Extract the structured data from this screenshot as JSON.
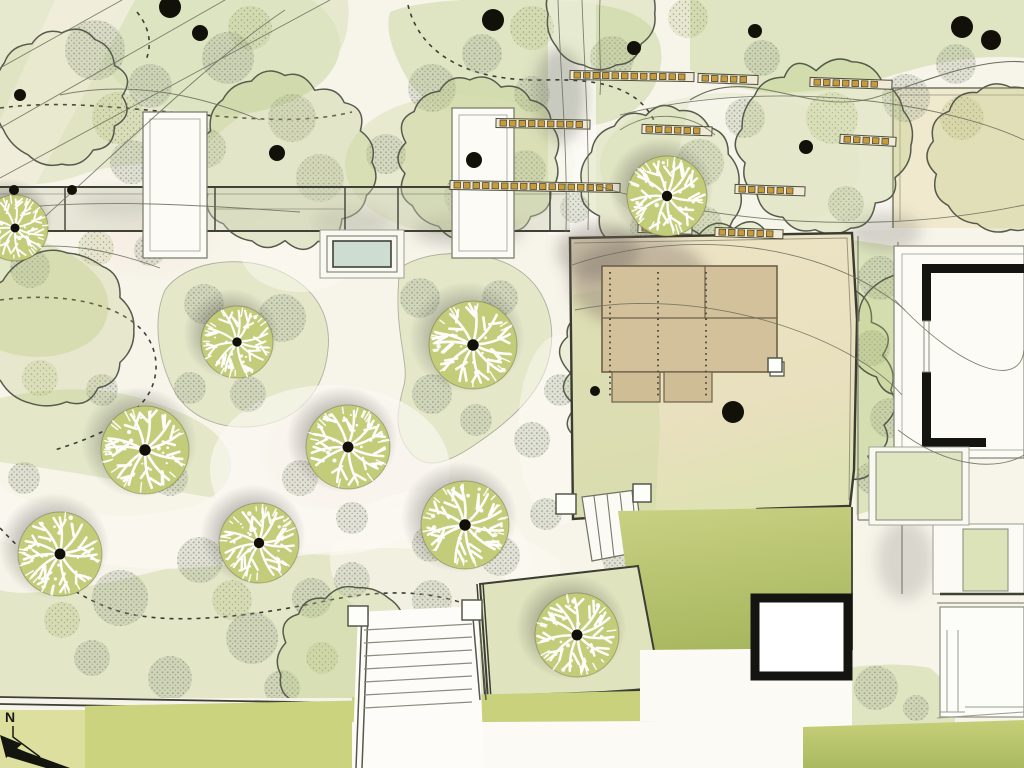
{
  "meta": {
    "type": "landscape-site-plan"
  },
  "north": {
    "label": "N"
  },
  "palette": {
    "paper": "#f7f4ea",
    "path_white": "#fbf9f2",
    "bed_green": "#e3e7c8",
    "bed_green_dark": "#dce3bd",
    "bright_bed": "#ccd37f",
    "lawn_top": "#c9d183",
    "lawn_bottom": "#a5b55c",
    "cream_lawn": "#f0e9cd",
    "terrace_cream": "#ebe3c3",
    "deck_tan": "#d3c19c",
    "deck_line": "#6e6049",
    "fence_amber": "#c89b3a",
    "fence_base": "#efe9d6",
    "tree_fill": "#c3cc79",
    "canopy_fill": "#b9c77e",
    "stipple_gray": "#8f9784",
    "stipple_olive": "#93a162",
    "ink": "#3c3e34",
    "ink_soft": "#565b4d",
    "wall_gray": "#7d8071",
    "water": "#cdddd2",
    "dot_black": "#111109",
    "shrub_wash_gray": "rgba(150,158,136,0.24)",
    "shrub_wash_olive": "rgba(165,175,115,0.20)"
  },
  "plan": {
    "round_trees": [
      {
        "x": 15,
        "y": 228,
        "r": 33
      },
      {
        "x": 237,
        "y": 342,
        "r": 36
      },
      {
        "x": 473,
        "y": 345,
        "r": 44
      },
      {
        "x": 667,
        "y": 196,
        "r": 40
      },
      {
        "x": 145,
        "y": 450,
        "r": 44
      },
      {
        "x": 348,
        "y": 447,
        "r": 42
      },
      {
        "x": 60,
        "y": 554,
        "r": 42
      },
      {
        "x": 259,
        "y": 543,
        "r": 40
      },
      {
        "x": 465,
        "y": 525,
        "r": 44
      },
      {
        "x": 577,
        "y": 635,
        "r": 42
      }
    ],
    "canopy_trees": [
      {
        "x": 285,
        "y": 162,
        "r": 86,
        "o": 0.32
      },
      {
        "x": 478,
        "y": 158,
        "r": 80,
        "o": 0.3
      },
      {
        "x": 662,
        "y": 186,
        "r": 76,
        "o": 0.26
      },
      {
        "x": 824,
        "y": 146,
        "r": 84,
        "o": 0.3
      },
      {
        "x": 1002,
        "y": 158,
        "r": 72,
        "o": 0.28
      },
      {
        "x": 58,
        "y": 330,
        "r": 74,
        "o": 0.28
      },
      {
        "x": 600,
        "y": 14,
        "r": 54,
        "o": 0.25
      },
      {
        "x": 62,
        "y": 96,
        "r": 66,
        "o": 0.12
      },
      {
        "x": 725,
        "y": 390,
        "r": 158,
        "o": 0.2
      },
      {
        "x": 348,
        "y": 658,
        "r": 70,
        "o": 0.26
      },
      {
        "x": 912,
        "y": 336,
        "r": 60,
        "o": 0.24
      }
    ],
    "shrubs": [
      [
        95,
        50,
        30,
        "g"
      ],
      [
        150,
        86,
        22,
        "g"
      ],
      [
        228,
        58,
        26,
        "g"
      ],
      [
        292,
        118,
        24,
        "g"
      ],
      [
        206,
        148,
        20,
        "g"
      ],
      [
        132,
        162,
        22,
        "g"
      ],
      [
        320,
        178,
        24,
        "g"
      ],
      [
        386,
        154,
        20,
        "g"
      ],
      [
        432,
        88,
        24,
        "g"
      ],
      [
        482,
        54,
        20,
        "g"
      ],
      [
        532,
        94,
        18,
        "g"
      ],
      [
        466,
        196,
        22,
        "g"
      ],
      [
        526,
        170,
        20,
        "g"
      ],
      [
        612,
        58,
        22,
        "g"
      ],
      [
        700,
        163,
        24,
        "g"
      ],
      [
        745,
        118,
        20,
        "g"
      ],
      [
        762,
        58,
        18,
        "g"
      ],
      [
        906,
        98,
        24,
        "g"
      ],
      [
        956,
        64,
        20,
        "g"
      ],
      [
        846,
        204,
        18,
        "g"
      ],
      [
        652,
        228,
        22,
        "g"
      ],
      [
        704,
        224,
        18,
        "g"
      ],
      [
        575,
        208,
        15,
        "g"
      ],
      [
        118,
        118,
        26,
        "o"
      ],
      [
        250,
        28,
        22,
        "o"
      ],
      [
        532,
        28,
        22,
        "o"
      ],
      [
        832,
        118,
        26,
        "o"
      ],
      [
        962,
        118,
        22,
        "o"
      ],
      [
        688,
        18,
        20,
        "o"
      ],
      [
        204,
        304,
        20,
        "g"
      ],
      [
        282,
        318,
        24,
        "g"
      ],
      [
        248,
        394,
        18,
        "g"
      ],
      [
        190,
        388,
        16,
        "g"
      ],
      [
        420,
        298,
        20,
        "g"
      ],
      [
        500,
        298,
        18,
        "g"
      ],
      [
        432,
        394,
        20,
        "g"
      ],
      [
        476,
        420,
        16,
        "g"
      ],
      [
        532,
        440,
        18,
        "g"
      ],
      [
        560,
        390,
        16,
        "g"
      ],
      [
        300,
        478,
        18,
        "g"
      ],
      [
        352,
        518,
        16,
        "g"
      ],
      [
        430,
        544,
        18,
        "g"
      ],
      [
        500,
        556,
        20,
        "g"
      ],
      [
        546,
        514,
        16,
        "g"
      ],
      [
        30,
        268,
        20,
        "g"
      ],
      [
        96,
        248,
        18,
        "o"
      ],
      [
        150,
        250,
        16,
        "g"
      ],
      [
        40,
        378,
        18,
        "o"
      ],
      [
        102,
        390,
        16,
        "g"
      ],
      [
        170,
        478,
        18,
        "g"
      ],
      [
        24,
        478,
        16,
        "g"
      ],
      [
        120,
        598,
        28,
        "g"
      ],
      [
        200,
        560,
        23,
        "g"
      ],
      [
        252,
        638,
        26,
        "g"
      ],
      [
        312,
        598,
        20,
        "g"
      ],
      [
        170,
        678,
        22,
        "g"
      ],
      [
        92,
        658,
        18,
        "g"
      ],
      [
        282,
        688,
        18,
        "g"
      ],
      [
        392,
        638,
        23,
        "g"
      ],
      [
        352,
        580,
        18,
        "g"
      ],
      [
        432,
        600,
        20,
        "g"
      ],
      [
        462,
        658,
        18,
        "g"
      ],
      [
        62,
        620,
        18,
        "o"
      ],
      [
        232,
        600,
        20,
        "o"
      ],
      [
        322,
        658,
        16,
        "o"
      ],
      [
        880,
        278,
        22,
        "g"
      ],
      [
        872,
        348,
        18,
        "g"
      ],
      [
        890,
        418,
        20,
        "g"
      ],
      [
        872,
        478,
        16,
        "g"
      ],
      [
        930,
        488,
        14,
        "g"
      ],
      [
        622,
        558,
        20,
        "g"
      ],
      [
        664,
        600,
        18,
        "g"
      ],
      [
        702,
        640,
        16,
        "g"
      ],
      [
        528,
        640,
        24,
        "o"
      ],
      [
        612,
        612,
        18,
        "g"
      ],
      [
        826,
        694,
        16,
        "g"
      ],
      [
        876,
        688,
        22,
        "g"
      ],
      [
        916,
        708,
        13,
        "g"
      ],
      [
        982,
        556,
        14,
        "g"
      ],
      [
        905,
        468,
        15,
        "g"
      ],
      [
        940,
        490,
        11,
        "g"
      ],
      [
        975,
        552,
        11,
        "g"
      ],
      [
        540,
        625,
        16,
        "g"
      ],
      [
        600,
        680,
        14,
        "g"
      ]
    ],
    "trunk_dots": [
      [
        170,
        7,
        11
      ],
      [
        493,
        20,
        11
      ],
      [
        733,
        412,
        11
      ],
      [
        962,
        27,
        11
      ],
      [
        991,
        40,
        10
      ],
      [
        200,
        33,
        8
      ],
      [
        277,
        153,
        8
      ],
      [
        474,
        160,
        8
      ],
      [
        634,
        48,
        7
      ],
      [
        755,
        31,
        7
      ],
      [
        806,
        147,
        7
      ],
      [
        20,
        95,
        6
      ],
      [
        14,
        190,
        5
      ],
      [
        72,
        190,
        5
      ],
      [
        595,
        391,
        5
      ]
    ],
    "fence_strips": [
      [
        498,
        123,
        90,
        1
      ],
      [
        572,
        75,
        120,
        1
      ],
      [
        700,
        78,
        56,
        2
      ],
      [
        812,
        82,
        78,
        2
      ],
      [
        644,
        129,
        66,
        2
      ],
      [
        842,
        139,
        52,
        3
      ],
      [
        452,
        185,
        166,
        1
      ],
      [
        737,
        189,
        66,
        2
      ],
      [
        640,
        228,
        50,
        2
      ],
      [
        717,
        232,
        64,
        2
      ]
    ],
    "piers": [
      [
        348,
        606,
        20
      ],
      [
        462,
        600,
        20
      ],
      [
        556,
        494,
        20
      ],
      [
        633,
        484,
        18
      ],
      [
        768,
        358,
        14
      ]
    ]
  }
}
